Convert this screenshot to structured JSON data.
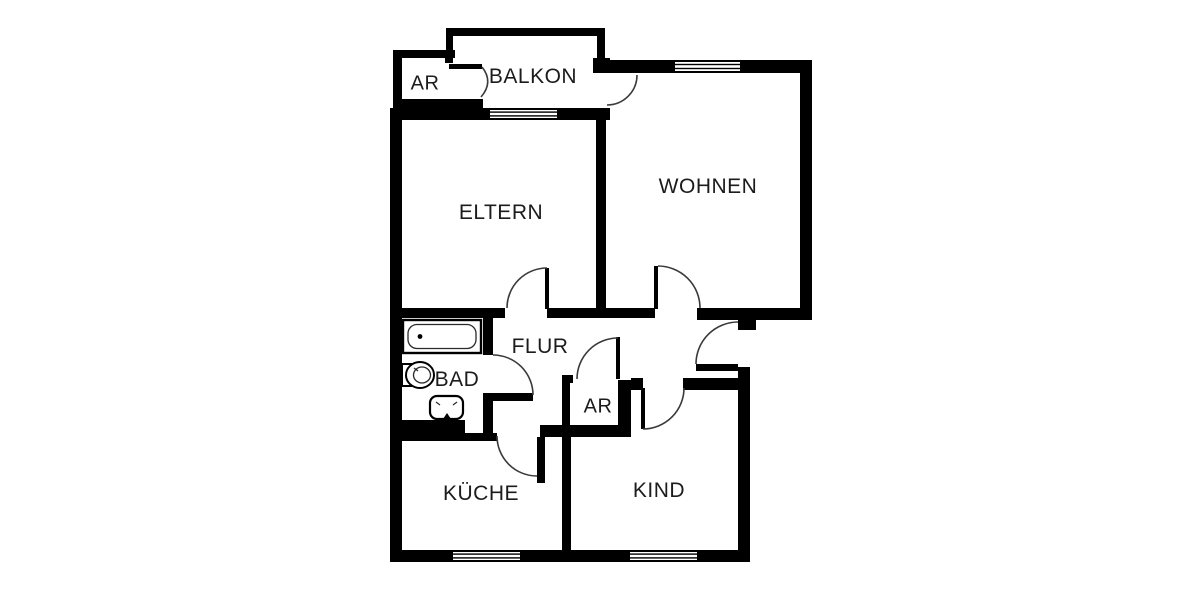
{
  "title": "Grundriss Wohnung (floor plan)",
  "rooms": [
    {
      "id": "ar-top",
      "label": "AR"
    },
    {
      "id": "balkon",
      "label": "BALKON"
    },
    {
      "id": "eltern",
      "label": "ELTERN"
    },
    {
      "id": "wohnen",
      "label": "WOHNEN"
    },
    {
      "id": "flur",
      "label": "FLUR"
    },
    {
      "id": "bad",
      "label": "BAD"
    },
    {
      "id": "ar-bottom",
      "label": "AR"
    },
    {
      "id": "kueche",
      "label": "KÜCHE"
    },
    {
      "id": "kind",
      "label": "KIND"
    }
  ],
  "fixtures": [
    "bathtub-icon",
    "toilet-icon",
    "sink-icon"
  ],
  "colors": {
    "wall": "#000000",
    "door_arc": "#3a3a3a",
    "text": "#1c1c1c",
    "background": "#ffffff"
  }
}
